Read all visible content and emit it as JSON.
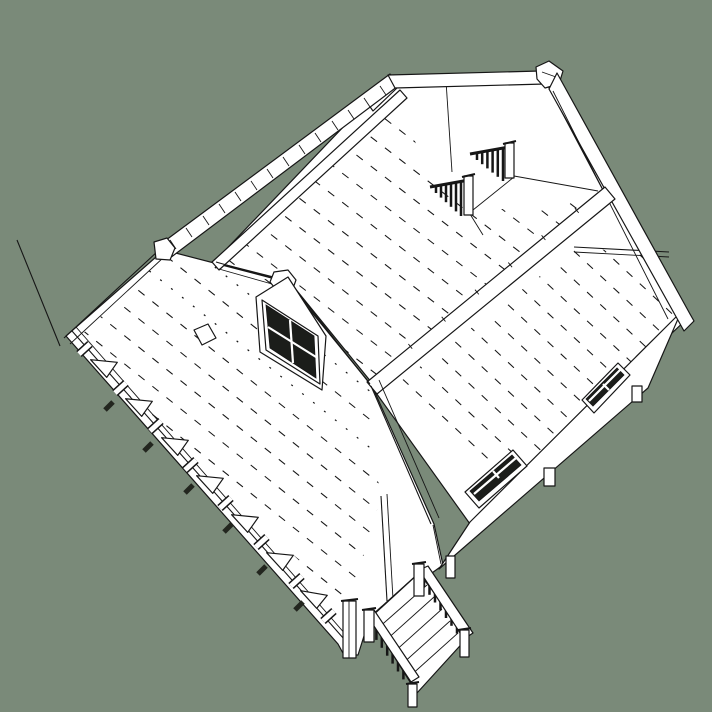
{
  "scene": {
    "description": "Hidden-line 3D render of a gabled house model, bird's-eye cutaway view",
    "render_style": "white faces with black edges",
    "view_angle": "aerial three-quarter, roof partially removed exposing attic floor"
  },
  "palette": {
    "background": "#7a8a79",
    "line": "#161616",
    "fill": "#ffffff",
    "glass": "#1b1d1a",
    "shadow": "#23261f"
  },
  "viewport": {
    "width": 712,
    "height": 712
  },
  "model": {
    "parts": [
      "axis-guide-line",
      "attic-floor-with-plank-lines",
      "rear-gable-wall",
      "ridge-cap-rear",
      "right-roof-plane",
      "right-side-wall",
      "window-right-upper",
      "window-right-lower",
      "left-gable",
      "left-gable-window",
      "porch-roof",
      "porch-fascia-with-knee-braces",
      "stairwell-railing-upper",
      "stairwell-railing-lower",
      "entry-stairs",
      "deck-posts"
    ],
    "stairwell_railings": 2,
    "stairwell_balusters_per_railing": 6,
    "entry_stair_railings": 2,
    "entry_stair_treads": 5,
    "porch_knee_braces": 7,
    "porch_posts": 8,
    "windows_right_wall": 2,
    "gable_windows": 1,
    "foundation_piers": 2
  }
}
